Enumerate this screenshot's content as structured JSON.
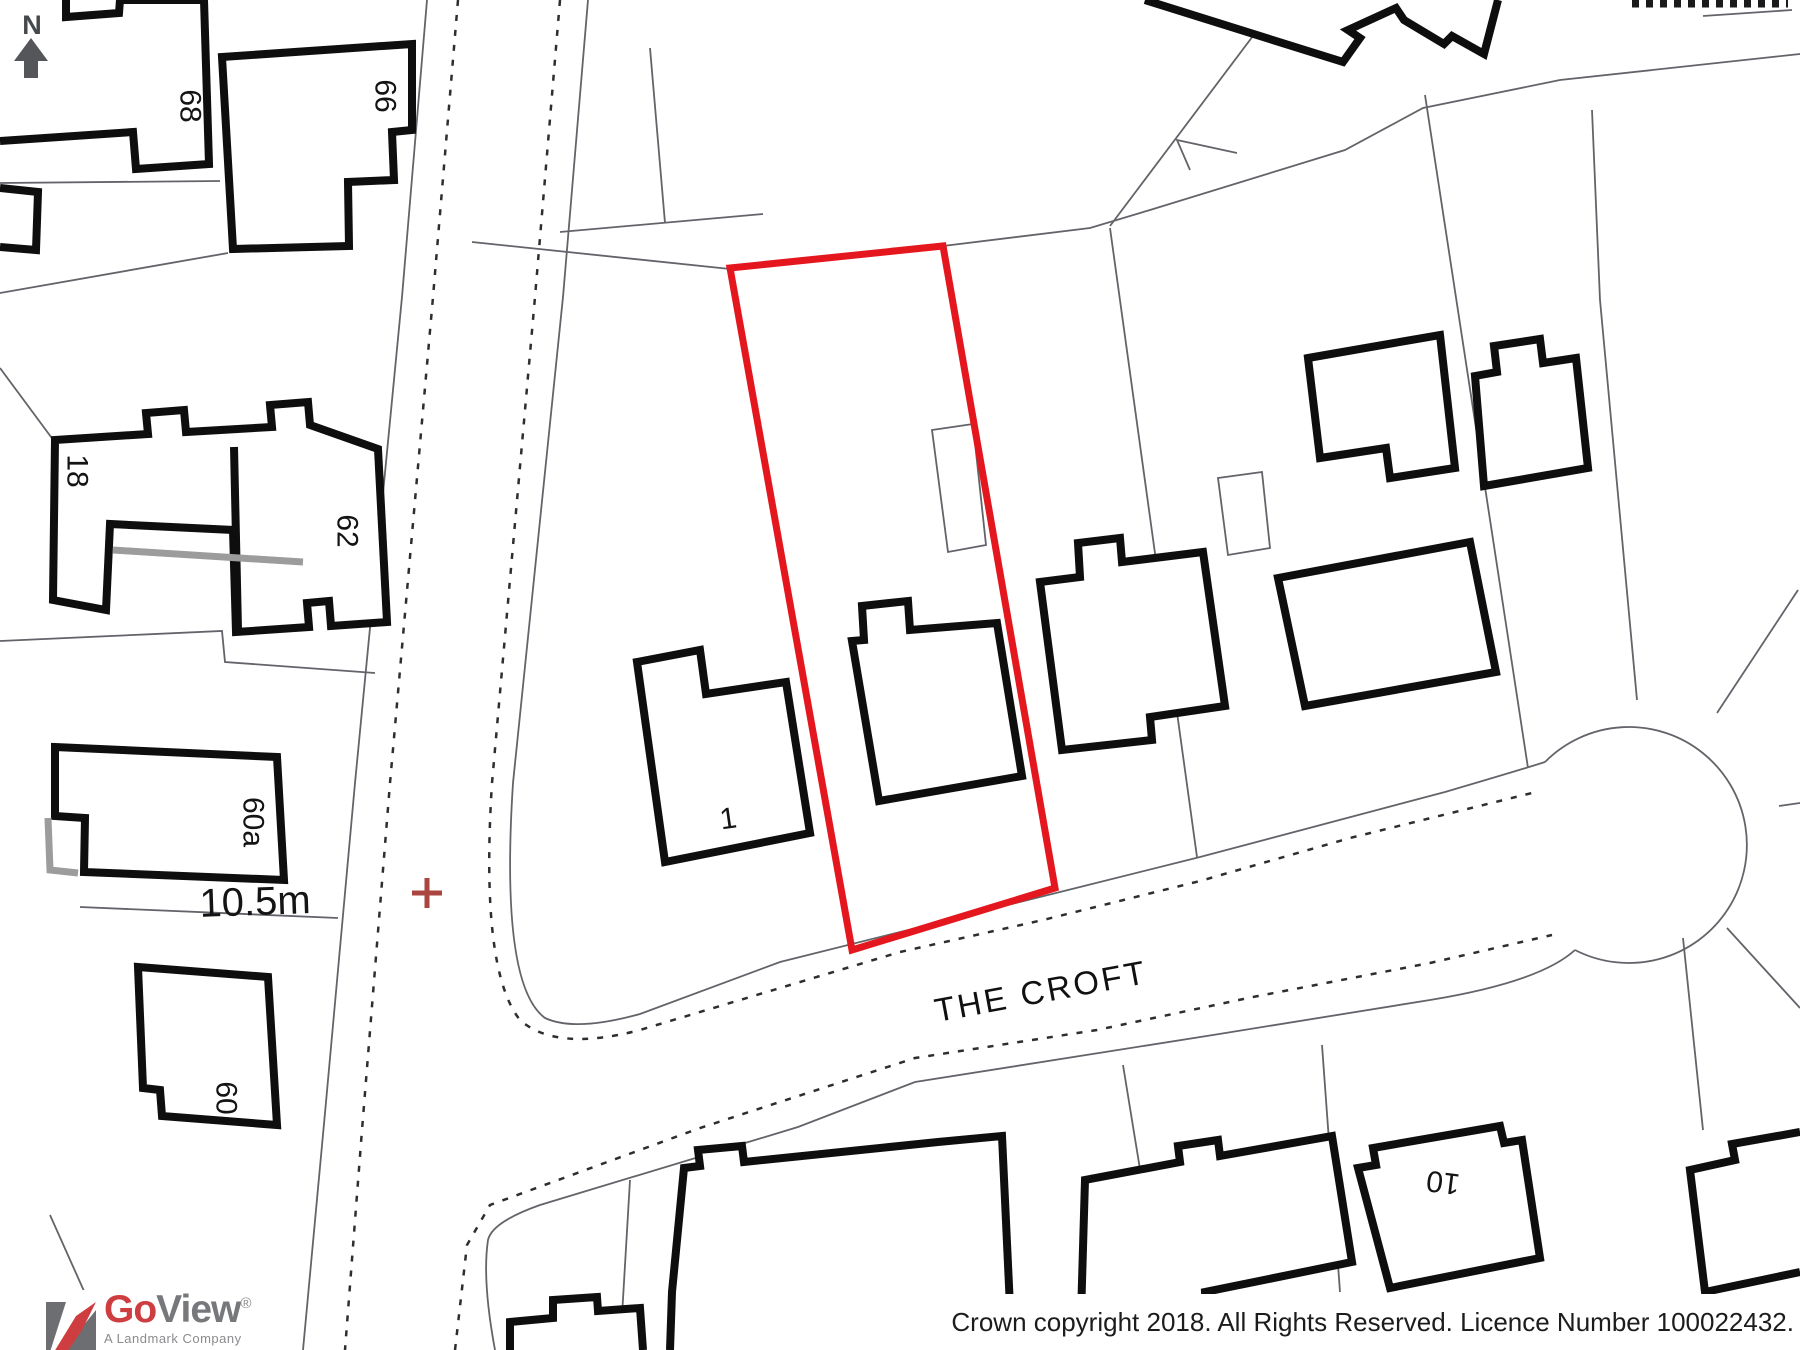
{
  "map": {
    "north_label": "N",
    "street_name": "THE CROFT",
    "measurement": "10.5m",
    "house_numbers": {
      "h68": "68",
      "h66": "66",
      "h18": "18",
      "h62": "62",
      "h60a": "60a",
      "h60": "60",
      "h1": "1",
      "h10": "10"
    },
    "colors": {
      "plot_outline": "#e4171e",
      "survey_cross": "#aa4540",
      "building_stroke": "#0e0e0e",
      "parcel_line": "#63646a",
      "wall_gray": "#9c9c9c"
    }
  },
  "footer": {
    "copyright": "Crown copyright 2018. All Rights Reserved. Licence Number 100022432."
  },
  "logo": {
    "brand_go": "Go",
    "brand_view": "View",
    "registered": "®",
    "tagline": "A Landmark Company",
    "colors": {
      "red": "#ce3d40",
      "gray": "#77787b",
      "square": "#6d6e71"
    }
  }
}
